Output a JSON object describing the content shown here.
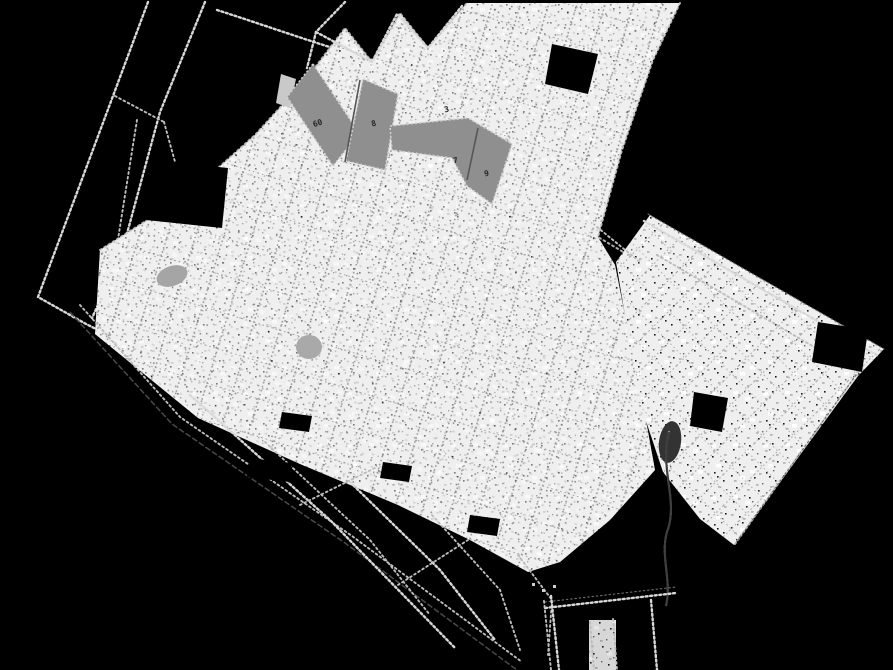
{
  "colors": {
    "background": "#000000",
    "paper": "#efefef",
    "ink_light": "#d8d8d8",
    "ink_mid": "#9a9a9a",
    "ink_dark": "#4a4a4a",
    "highlight": "#8f8f8f",
    "highlight_edge": "#d0d0d0"
  },
  "labels": {
    "building_1": "60",
    "building_2": "8",
    "building_3": "3",
    "building_4": "7",
    "building_5": "9"
  }
}
